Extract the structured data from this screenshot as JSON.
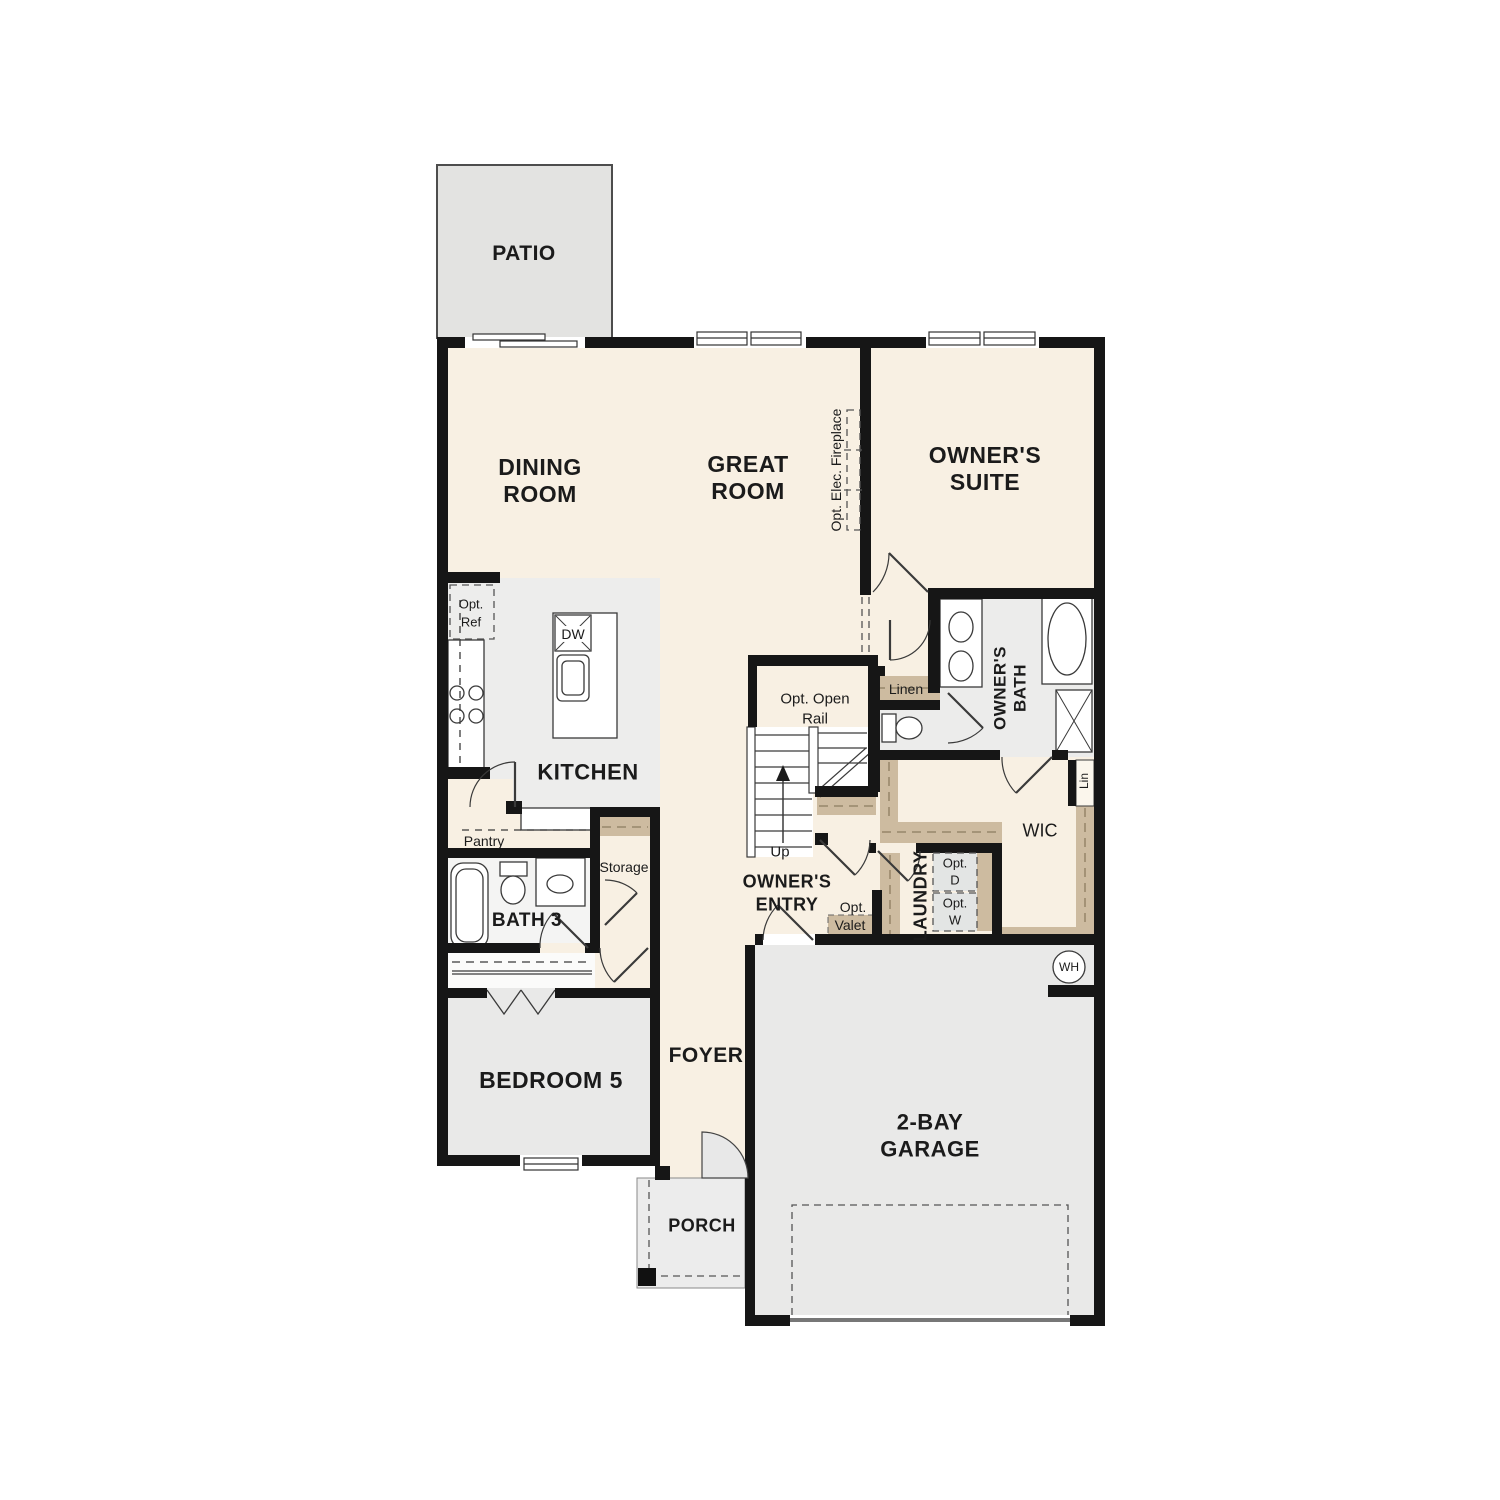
{
  "plan_title": "single-story floor plan",
  "colors": {
    "wall": "#161616",
    "cream_floor": "#f8f0e3",
    "gray_floor": "#eaeae9",
    "patio_gray": "#e3e3e1",
    "shelf_tan": "#cdbba0",
    "fixture_line": "#3a3a3a"
  },
  "labels": {
    "patio": "PATIO",
    "dining1": "DINING",
    "dining2": "ROOM",
    "great1": "GREAT",
    "great2": "ROOM",
    "suite1": "OWNER'S",
    "suite2": "SUITE",
    "kitchen": "KITCHEN",
    "bath3": "BATH 3",
    "bedroom5": "BEDROOM 5",
    "foyer": "FOYER",
    "porch": "PORCH",
    "garage1": "2-BAY",
    "garage2": "GARAGE",
    "entry1": "OWNER'S",
    "entry2": "ENTRY",
    "obath1": "OWNER'S",
    "obath2": "BATH",
    "laundry": "LAUNDRY",
    "wic": "WIC",
    "linen": "Linen",
    "lin": "Lin",
    "storage": "Storage",
    "pantry": "Pantry",
    "up": "Up",
    "rail1": "Opt. Open",
    "rail2": "Rail",
    "fireplace": "Opt. Elec. Fireplace",
    "optref1": "Opt.",
    "optref2": "Ref",
    "optvalet1": "Opt.",
    "optvalet2": "Valet",
    "optd1": "Opt.",
    "optd2": "D",
    "optw1": "Opt.",
    "optw2": "W",
    "dw": "DW",
    "wh": "WH"
  }
}
